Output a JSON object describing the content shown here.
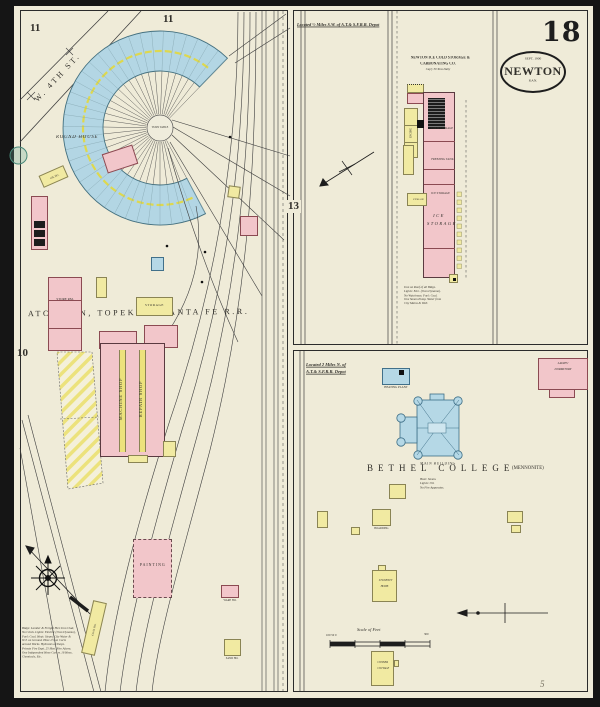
{
  "sheet": {
    "num": "18",
    "stamp_date": "SEPT. 1900",
    "stamp_city": "NEWTON",
    "stamp_state": "KAN.",
    "pencil": "5"
  },
  "adj": {
    "a11a": "11",
    "a11b": "11",
    "a13": "13",
    "a10": "10"
  },
  "lp": {
    "street": "W. 4TH ST.",
    "round": "ROUND HOUSE",
    "turn": "TURN TABLE",
    "rr": "ATCHISON, TOPEKA & SANTA FE R.R.",
    "oil": "OIL HO.",
    "store": "STORE RM.",
    "storage": "STORAGE",
    "mach": "MACHINE SHOP",
    "rep": "REPAIR SHOP",
    "paint": "PAINTING",
    "coal": "COAL HO.",
    "ware": "WARE HO.",
    "sand": "SAND HO.",
    "notes": [
      "Bldgs: Lumber & Freight Ho's Iron Clad,",
      "No Clock. Lights: Electric (Own Dynamo),",
      "Fuel: Coal. Heat: Steam. City Water &",
      "W.T. on Ground. Hose 2½ on Carts",
      "around Works. Hydrants at Shops.",
      "Private Fire Dept. 25 Men. Fire Alarm.",
      "One Independent Hose Cart w. 16 Hose,",
      "Chemicals, Etc."
    ]
  },
  "ice": {
    "located": "Located ½ Miles S.W. of A.T.& S.F.R.R. Depot",
    "co1": "NEWTON ICE COLD STORAGE &",
    "co2": "CARBONATING CO.",
    "co3": "Cap'y 30 Tons Daily",
    "cold": "COLD STORAGE",
    "freeze": "FREEZING TANK",
    "ice1": "ICE STORAGE",
    "ice2a": "ICE",
    "ice2b": "STORAGE",
    "engine": "ENGINE",
    "stor": "STORAGE",
    "notes": [
      "Iron on Roof of all Bldgs.",
      "Lights: Elec. (Own Dynamo).",
      "No Watchman. Fuel: Coal.",
      "One Steam Pump. Water from",
      "City Mains & Well."
    ]
  },
  "col": {
    "loc1": "Located 2 Miles N. of",
    "loc2": "A.T.& S.F.R.R. Depot",
    "heat": "HEATING PLANT",
    "dorm1": "LADIES'",
    "dorm2": "DORMITORY",
    "mainb": "MAIN  BUILDING",
    "name": "BETHEL COLLEGE",
    "sub": "(MENNONITE)",
    "board": "BOARDING",
    "stu1": "STUDENTS'",
    "stu2": "HOME",
    "cot1": "CONNER",
    "cot2": "COTTAGE",
    "scale": "Scale of Feet",
    "sl": "100  50  0",
    "sr": "300",
    "notes": [
      "Heat: Steam.",
      "Lights: Oil.",
      "No Fire Apparatus."
    ]
  }
}
